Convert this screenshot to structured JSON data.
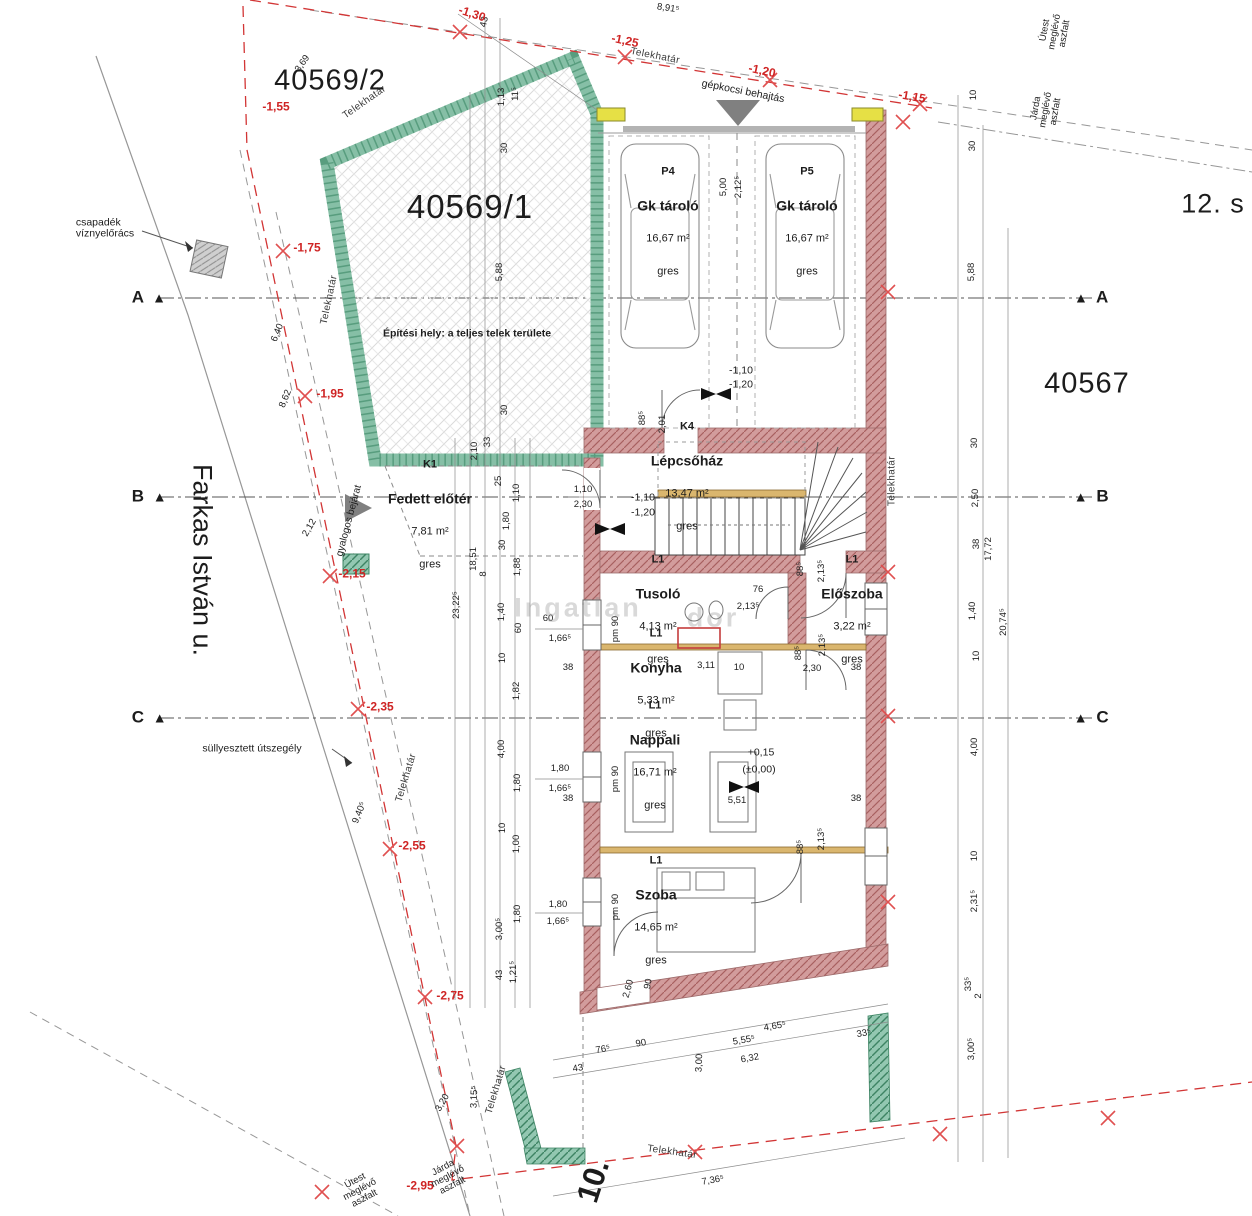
{
  "parcels": {
    "p40569_1": "40569/1",
    "p40569_2": "40569/2",
    "p40567": "40567",
    "street": "Farkas István u.",
    "street_no": "12. s",
    "house_no": "10."
  },
  "notes": {
    "csapadek": "csapadék\nvíznyelőrács",
    "sullyesztett": "süllyesztett útszegély",
    "gyalogos": "gyalogos bejárat",
    "gepkocsi": "gépkocsi behajtás",
    "epitesi": "Építési hely: a teljes telek területe"
  },
  "watermark": {
    "part1": "Ingatlan",
    "part2": "dor"
  },
  "rooms": [
    {
      "code": "P4",
      "name": "Gk tároló",
      "area": "16,67 m²",
      "floor": "gres",
      "x": 668,
      "y": 222
    },
    {
      "code": "P5",
      "name": "Gk tároló",
      "area": "16,67 m²",
      "floor": "gres",
      "x": 807,
      "y": 222
    },
    {
      "code": "K4",
      "name": "Lépcsőház",
      "area": "13,47 m²",
      "floor": "gres",
      "x": 687,
      "y": 477
    },
    {
      "code": "K1",
      "name": "Fedett előtér",
      "area": "7,81 m²",
      "floor": "gres",
      "x": 430,
      "y": 515
    },
    {
      "code": "L1",
      "name": "Tusoló",
      "area": "4,13 m²",
      "floor": "gres",
      "x": 658,
      "y": 610
    },
    {
      "code": "L1",
      "name": "Előszoba",
      "area": "3,22 m²",
      "floor": "gres",
      "x": 852,
      "y": 610
    },
    {
      "code": "L1",
      "name": "Konyha",
      "area": "5,33 m²",
      "floor": "gres",
      "x": 656,
      "y": 684
    },
    {
      "code": "L1",
      "name": "Nappali",
      "area": "16,71 m²",
      "floor": "gres",
      "x": 655,
      "y": 756
    },
    {
      "code": "L1",
      "name": "Szoba",
      "area": "14,65 m²",
      "floor": "gres",
      "x": 656,
      "y": 911
    }
  ],
  "reds": [
    {
      "t": "-1,30",
      "x": 472,
      "y": 14,
      "r": 18
    },
    {
      "t": "-1,25",
      "x": 625,
      "y": 41,
      "r": 12
    },
    {
      "t": "-1,20",
      "x": 762,
      "y": 71,
      "r": 12
    },
    {
      "t": "-1,15",
      "x": 912,
      "y": 97,
      "r": 10
    },
    {
      "t": "-1,55",
      "x": 276,
      "y": 107
    },
    {
      "t": "-1,75",
      "x": 307,
      "y": 248
    },
    {
      "t": "-1,95",
      "x": 330,
      "y": 394
    },
    {
      "t": "-2,15",
      "x": 352,
      "y": 574
    },
    {
      "t": "-2,35",
      "x": 380,
      "y": 707
    },
    {
      "t": "-2,55",
      "x": 412,
      "y": 846
    },
    {
      "t": "-2,75",
      "x": 450,
      "y": 996
    },
    {
      "t": "-2,95",
      "x": 420,
      "y": 1186
    }
  ],
  "elevs": [
    {
      "t": "-1,10",
      "x": 741,
      "y": 371
    },
    {
      "t": "-1,20",
      "x": 741,
      "y": 385
    },
    {
      "t": "-1,10",
      "x": 643,
      "y": 498
    },
    {
      "t": "-1,20",
      "x": 643,
      "y": 513
    },
    {
      "t": "+0,15",
      "x": 761,
      "y": 753
    },
    {
      "t": "(±0,00)",
      "x": 759,
      "y": 770
    }
  ],
  "bounds": [
    {
      "t": "Telekhatár",
      "x": 365,
      "y": 103,
      "r": -35
    },
    {
      "t": "Telekhatár",
      "x": 655,
      "y": 57,
      "r": 11
    },
    {
      "t": "Telekhatár",
      "x": 330,
      "y": 300,
      "r": -78
    },
    {
      "t": "Telekhatár",
      "x": 893,
      "y": 481,
      "r": -90
    },
    {
      "t": "Telekhatár",
      "x": 407,
      "y": 778,
      "r": -73
    },
    {
      "t": "Telekhatár",
      "x": 497,
      "y": 1090,
      "r": -73
    },
    {
      "t": "Telekhatár",
      "x": 672,
      "y": 1153,
      "r": 8
    }
  ],
  "roads": [
    {
      "l1": "Útest",
      "l2": "meglévő",
      "l3": "aszfalt",
      "x": 1055,
      "y": 32,
      "r": -80
    },
    {
      "l1": "Járda",
      "l2": "meglévő",
      "l3": "aszfalt",
      "x": 1046,
      "y": 110,
      "r": -80
    },
    {
      "l1": "Útest",
      "l2": "meglévő",
      "l3": "aszfalt",
      "x": 360,
      "y": 1190,
      "r": -28
    },
    {
      "l1": "Járda",
      "l2": "meglévő",
      "l3": "aszfalt",
      "x": 448,
      "y": 1177,
      "r": -28
    }
  ],
  "grid_left": [
    {
      "letter": "A",
      "tri": "▲",
      "x": 130,
      "y": 298
    },
    {
      "letter": "B",
      "tri": "▲",
      "x": 130,
      "y": 497
    },
    {
      "letter": "C",
      "tri": "▲",
      "x": 130,
      "y": 718
    }
  ],
  "grid_right": [
    {
      "letter": "A",
      "tri": "▲",
      "x": 1072,
      "y": 298
    },
    {
      "letter": "B",
      "tri": "▲",
      "x": 1072,
      "y": 497
    },
    {
      "letter": "C",
      "tri": "▲",
      "x": 1072,
      "y": 718
    }
  ],
  "dims": [
    {
      "t": "43",
      "x": 485,
      "y": 22,
      "r": -78
    },
    {
      "t": "1,13",
      "x": 502,
      "y": 97,
      "r": -90
    },
    {
      "t": "11⁵",
      "x": 516,
      "y": 94,
      "r": -90
    },
    {
      "t": "30",
      "x": 505,
      "y": 148,
      "r": -90
    },
    {
      "t": "3,69",
      "x": 303,
      "y": 64,
      "r": -55
    },
    {
      "t": "8,91⁵",
      "x": 668,
      "y": 9,
      "r": 8
    },
    {
      "t": "5,00",
      "x": 724,
      "y": 187,
      "r": -90
    },
    {
      "t": "2,12⁵",
      "x": 739,
      "y": 187,
      "r": -90
    },
    {
      "t": "10",
      "x": 974,
      "y": 95,
      "r": -90
    },
    {
      "t": "30",
      "x": 973,
      "y": 146,
      "r": -90
    },
    {
      "t": "5,88",
      "x": 972,
      "y": 272,
      "r": -90
    },
    {
      "t": "30",
      "x": 975,
      "y": 443,
      "r": -90
    },
    {
      "t": "2,50",
      "x": 976,
      "y": 498,
      "r": -90
    },
    {
      "t": "38",
      "x": 977,
      "y": 544,
      "r": -90
    },
    {
      "t": "17,72",
      "x": 989,
      "y": 549,
      "r": -90
    },
    {
      "t": "1,40",
      "x": 973,
      "y": 611,
      "r": -90
    },
    {
      "t": "10",
      "x": 977,
      "y": 656,
      "r": -90
    },
    {
      "t": "20,74⁵",
      "x": 1004,
      "y": 622,
      "r": -90
    },
    {
      "t": "4,00",
      "x": 975,
      "y": 747,
      "r": -90
    },
    {
      "t": "10",
      "x": 975,
      "y": 856,
      "r": -90
    },
    {
      "t": "2,31⁵",
      "x": 975,
      "y": 901,
      "r": -90
    },
    {
      "t": "33⁵",
      "x": 969,
      "y": 984,
      "r": -90
    },
    {
      "t": "2",
      "x": 979,
      "y": 996,
      "r": -90
    },
    {
      "t": "3,00⁵",
      "x": 972,
      "y": 1049,
      "r": -90
    },
    {
      "t": "5,88",
      "x": 500,
      "y": 272,
      "r": -90
    },
    {
      "t": "30",
      "x": 505,
      "y": 410,
      "r": -90
    },
    {
      "t": "33",
      "x": 488,
      "y": 442,
      "r": -90
    },
    {
      "t": "2,10",
      "x": 475,
      "y": 451,
      "r": -90
    },
    {
      "t": "6,40",
      "x": 278,
      "y": 333,
      "r": -68
    },
    {
      "t": "8,62",
      "x": 286,
      "y": 399,
      "r": -68
    },
    {
      "t": "2,12",
      "x": 310,
      "y": 528,
      "r": -60
    },
    {
      "t": "9,40⁵",
      "x": 360,
      "y": 813,
      "r": -68
    },
    {
      "t": "3,20",
      "x": 443,
      "y": 1103,
      "r": -60
    },
    {
      "t": "3,15⁵",
      "x": 475,
      "y": 1097,
      "r": -88
    },
    {
      "t": "25",
      "x": 499,
      "y": 481,
      "r": -90
    },
    {
      "t": "1,10",
      "x": 517,
      "y": 493,
      "r": -90
    },
    {
      "t": "1,80",
      "x": 507,
      "y": 521,
      "r": -90
    },
    {
      "t": "30",
      "x": 503,
      "y": 545,
      "r": -90
    },
    {
      "t": "18,51",
      "x": 474,
      "y": 559,
      "r": -90
    },
    {
      "t": "8",
      "x": 484,
      "y": 574,
      "r": -90
    },
    {
      "t": "1,88",
      "x": 518,
      "y": 567,
      "r": -90
    },
    {
      "t": "23,22⁵",
      "x": 457,
      "y": 605,
      "r": -90
    },
    {
      "t": "1,40",
      "x": 502,
      "y": 612,
      "r": -90
    },
    {
      "t": "60",
      "x": 519,
      "y": 628,
      "r": -90
    },
    {
      "t": "10",
      "x": 503,
      "y": 658,
      "r": -90
    },
    {
      "t": "1,82",
      "x": 517,
      "y": 691,
      "r": -90
    },
    {
      "t": "4,00",
      "x": 502,
      "y": 749,
      "r": -90
    },
    {
      "t": "1,80",
      "x": 518,
      "y": 783,
      "r": -90
    },
    {
      "t": "10",
      "x": 503,
      "y": 828,
      "r": -90
    },
    {
      "t": "1,00",
      "x": 517,
      "y": 844,
      "r": -90
    },
    {
      "t": "1,80",
      "x": 518,
      "y": 914,
      "r": -90
    },
    {
      "t": "3,00⁵",
      "x": 500,
      "y": 929,
      "r": -90
    },
    {
      "t": "43",
      "x": 500,
      "y": 975,
      "r": -90
    },
    {
      "t": "1,21⁵",
      "x": 514,
      "y": 972,
      "r": -90
    },
    {
      "t": "60",
      "x": 548,
      "y": 619
    },
    {
      "t": "1,66⁵",
      "x": 560,
      "y": 639
    },
    {
      "t": "38",
      "x": 568,
      "y": 668
    },
    {
      "t": "1,80",
      "x": 560,
      "y": 769
    },
    {
      "t": "1,66⁵",
      "x": 560,
      "y": 789
    },
    {
      "t": "38",
      "x": 568,
      "y": 799
    },
    {
      "t": "1,80",
      "x": 558,
      "y": 905
    },
    {
      "t": "1,66⁵",
      "x": 558,
      "y": 922
    },
    {
      "t": "pm 90",
      "x": 616,
      "y": 629,
      "r": -90
    },
    {
      "t": "pm 90",
      "x": 616,
      "y": 779,
      "r": -90
    },
    {
      "t": "pm 90",
      "x": 616,
      "y": 907,
      "r": -90
    },
    {
      "t": "88⁵",
      "x": 643,
      "y": 418,
      "r": -90
    },
    {
      "t": "2,01",
      "x": 663,
      "y": 424,
      "r": -90
    },
    {
      "t": "1,10",
      "x": 583,
      "y": 490
    },
    {
      "t": "2,30",
      "x": 583,
      "y": 505
    },
    {
      "t": "76",
      "x": 758,
      "y": 590
    },
    {
      "t": "2,13⁵",
      "x": 748,
      "y": 607
    },
    {
      "t": "88⁵",
      "x": 801,
      "y": 569,
      "r": -90
    },
    {
      "t": "2,13⁵",
      "x": 822,
      "y": 571,
      "r": -90
    },
    {
      "t": "88⁵",
      "x": 799,
      "y": 653,
      "r": -90
    },
    {
      "t": "2,13⁵",
      "x": 823,
      "y": 645,
      "r": -90
    },
    {
      "t": "2,30",
      "x": 812,
      "y": 669
    },
    {
      "t": "38",
      "x": 856,
      "y": 668
    },
    {
      "t": "3,11",
      "x": 706,
      "y": 666
    },
    {
      "t": "10",
      "x": 739,
      "y": 668
    },
    {
      "t": "5,51",
      "x": 737,
      "y": 801
    },
    {
      "t": "38",
      "x": 856,
      "y": 799
    },
    {
      "t": "88⁵",
      "x": 801,
      "y": 847,
      "r": -90
    },
    {
      "t": "2,13⁵",
      "x": 822,
      "y": 839,
      "r": -90
    },
    {
      "t": "2,60",
      "x": 629,
      "y": 989,
      "r": -75
    },
    {
      "t": "90",
      "x": 649,
      "y": 984,
      "r": -80
    },
    {
      "t": "43",
      "x": 578,
      "y": 1069,
      "r": -10
    },
    {
      "t": "76⁵",
      "x": 603,
      "y": 1050,
      "r": -10
    },
    {
      "t": "90",
      "x": 641,
      "y": 1044,
      "r": -10
    },
    {
      "t": "3,00",
      "x": 700,
      "y": 1063,
      "r": -88
    },
    {
      "t": "5,55⁵",
      "x": 744,
      "y": 1041,
      "r": -10
    },
    {
      "t": "6,32",
      "x": 750,
      "y": 1059,
      "r": -10
    },
    {
      "t": "4,65⁵",
      "x": 775,
      "y": 1027,
      "r": -10
    },
    {
      "t": "33⁵",
      "x": 864,
      "y": 1034,
      "r": -10
    },
    {
      "t": "7,36⁵",
      "x": 713,
      "y": 1181,
      "r": -10
    }
  ]
}
